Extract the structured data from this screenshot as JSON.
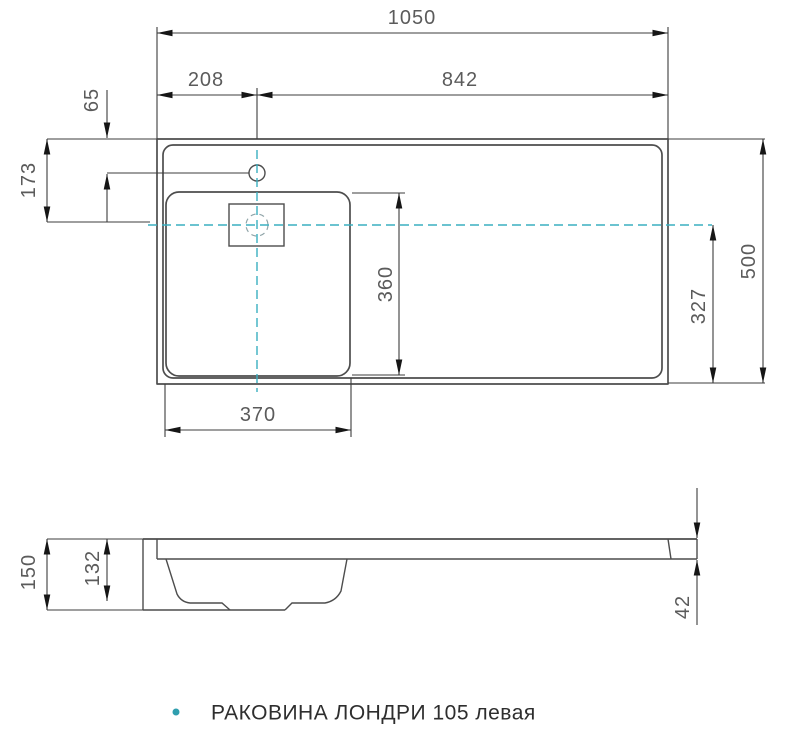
{
  "colors": {
    "object_line": "#4d4d4d",
    "dimension_line": "#3c3c3c",
    "centerline": "#3aafc0",
    "dim_text": "#5b5b5b",
    "caption_text": "#2e2e2e",
    "caption_bullet": "#2f9eae"
  },
  "top_view": {
    "dims": {
      "total_width": "1050",
      "faucet_offset_left": "208",
      "span_right": "842",
      "faucet_from_back": "65",
      "centerline_from_back": "173",
      "basin_width": "370",
      "basin_depth": "360",
      "centerline_to_front": "327",
      "total_depth": "500"
    }
  },
  "side_view": {
    "dims": {
      "total_height": "150",
      "bowl_height": "132",
      "slab_thickness": "42"
    }
  },
  "caption": {
    "text": "РАКОВИНА ЛОНДРИ 105 левая"
  }
}
